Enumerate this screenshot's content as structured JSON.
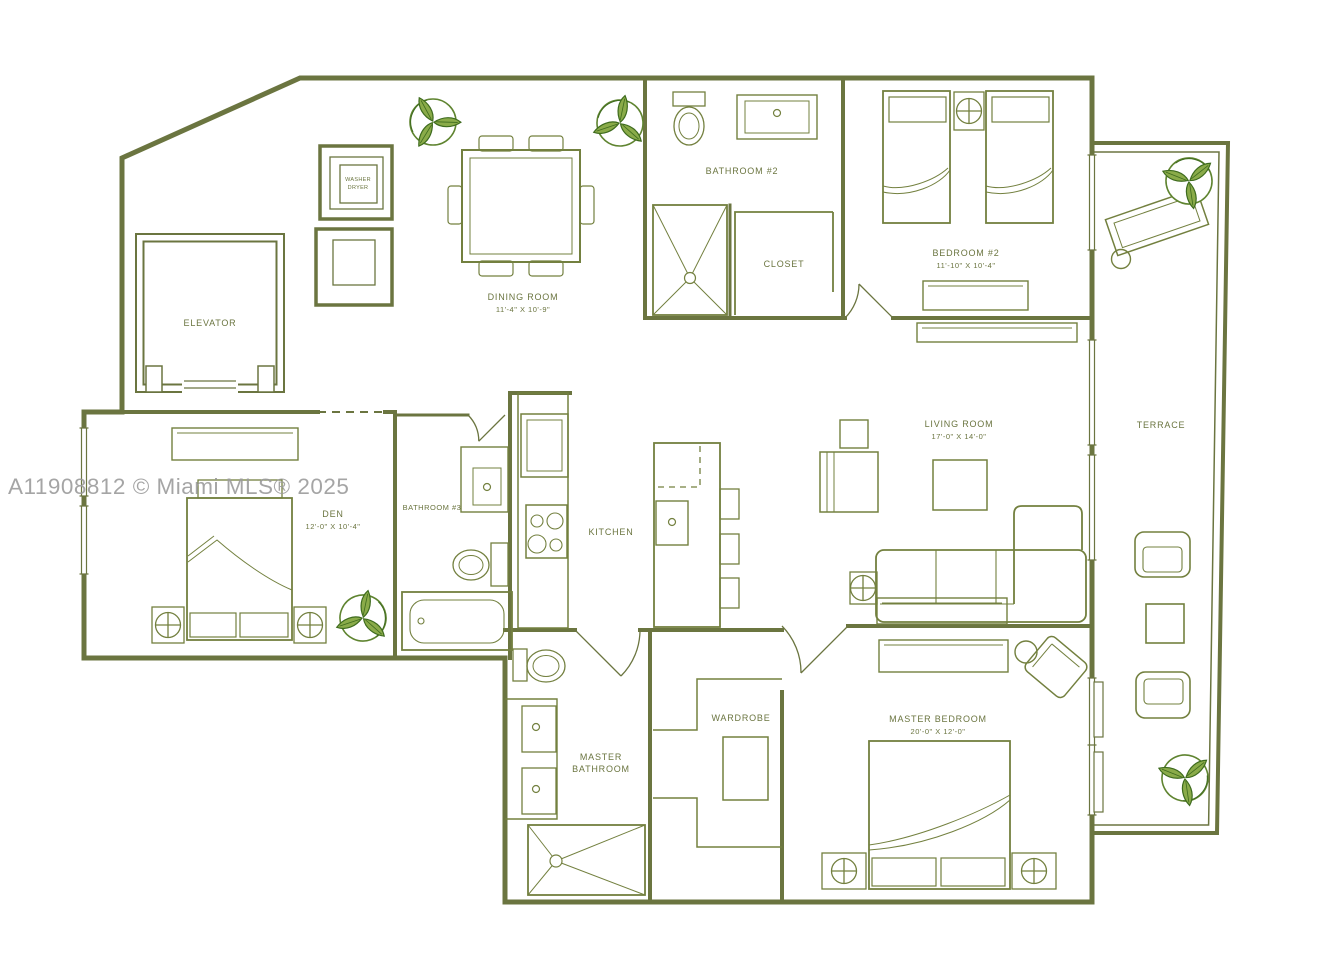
{
  "watermark": "A11908812 © Miami MLS® 2025",
  "palette": {
    "wall_line": "#6B7540",
    "furniture_line": "#73803F",
    "label_text": "#6B7540",
    "watermark_gray": "#9C9C9C",
    "plant_light": "#8AAB49",
    "plant_dark": "#3E6B1E",
    "background": "#FFFFFF"
  },
  "rooms": {
    "elevator": {
      "name": "ELEVATOR"
    },
    "laundry": {
      "line1": "WASHER",
      "line2": "DRYER"
    },
    "dining": {
      "name": "DINING ROOM",
      "dims": "11'-4\" X 10'-9\""
    },
    "bathroom2": {
      "name": "BATHROOM #2"
    },
    "closet": {
      "name": "CLOSET"
    },
    "bedroom2": {
      "name": "BEDROOM #2",
      "dims": "11'-10\" X 10'-4\""
    },
    "living": {
      "name": "LIVING ROOM",
      "dims": "17'-0\" X 14'-0\""
    },
    "terrace": {
      "name": "TERRACE"
    },
    "den": {
      "name": "DEN",
      "dims": "12'-0\" X 10'-4\""
    },
    "bathroom3": {
      "name": "BATHROOM #3"
    },
    "kitchen": {
      "name": "KITCHEN"
    },
    "master_bath": {
      "line1": "MASTER",
      "line2": "BATHROOM"
    },
    "wardrobe": {
      "name": "WARDROBE"
    },
    "master_bedroom": {
      "name": "MASTER BEDROOM",
      "dims": "20'-0\" X 12'-0\""
    }
  }
}
